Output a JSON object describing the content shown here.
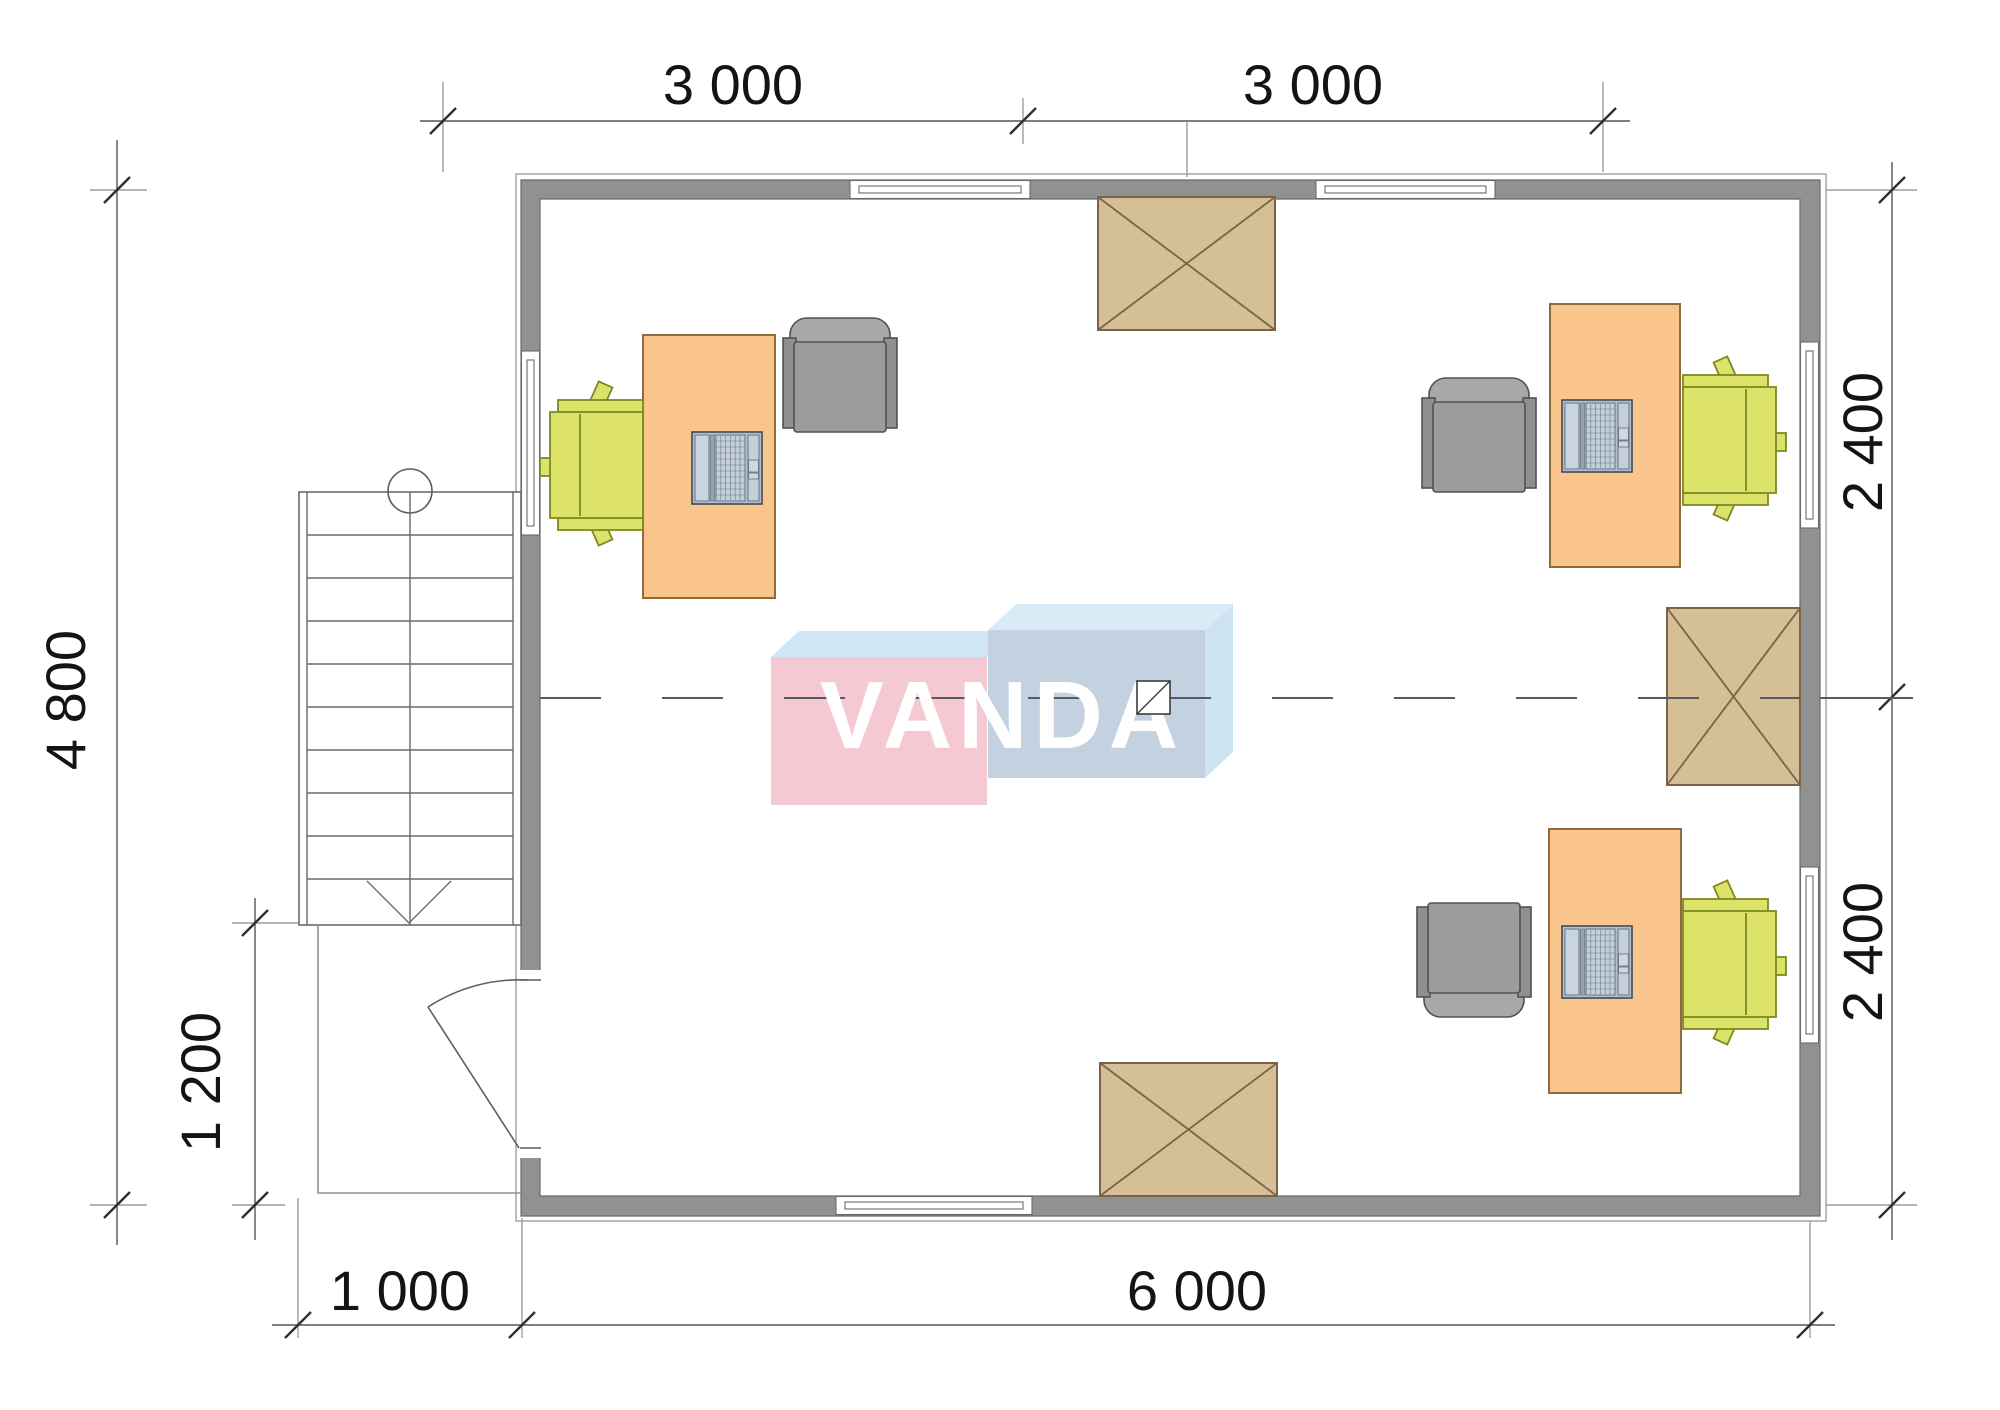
{
  "watermark": {
    "text": "VANDA"
  },
  "dimensions": {
    "top": [
      "3 000",
      "3 000"
    ],
    "right": [
      "2 400",
      "2 400"
    ],
    "left": "4 800",
    "left_inner": "1 200",
    "bottom": [
      "1 000",
      "6 000"
    ]
  },
  "theme": {
    "wall": "#919191",
    "desk": "#fac58c",
    "chair_green": "#dde368",
    "chair_grey": "#9c9c9c",
    "hatch": "#d4bf97",
    "logo_pink": "#f4c9d2",
    "logo_blue_face": "#c3d1e1",
    "logo_blue_top": "#d8ebf7",
    "logo_blue_side": "#cfe4f2",
    "line": "#555555",
    "text": "#141414"
  }
}
